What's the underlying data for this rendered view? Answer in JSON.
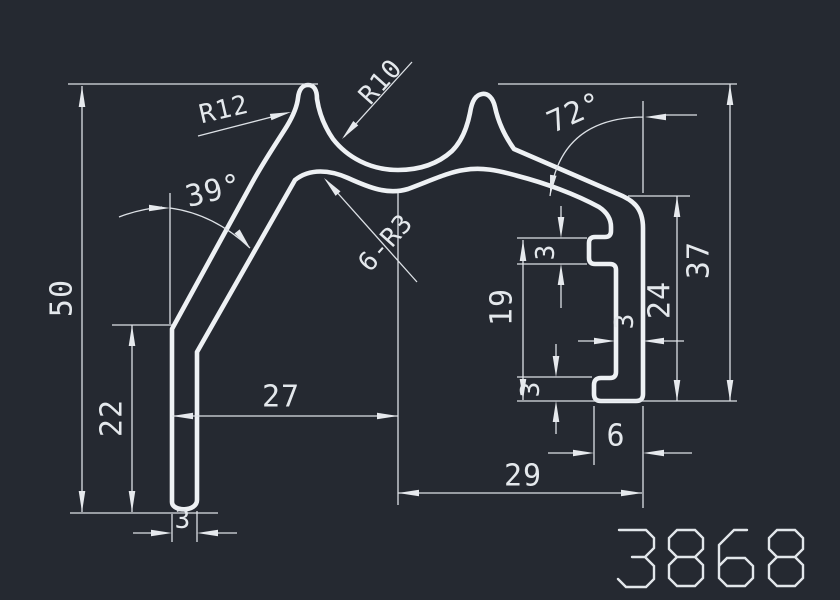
{
  "drawing": {
    "part_number": "3868",
    "background": "#252931",
    "line_color": "#eef1f4",
    "dim_color": "#dde1e6",
    "dims": {
      "h50": "50",
      "h22": "22",
      "w27": "27",
      "w3_leg": "3",
      "w29": "29",
      "h19": "19",
      "h3_top": "3",
      "h3_bot": "3",
      "w3_wall": "3",
      "h24": "24",
      "h37": "37",
      "w6": "6",
      "a39": "39°",
      "a72": "72°",
      "r12": "R12",
      "r10": "R10",
      "r6r3": "6-R3"
    }
  }
}
